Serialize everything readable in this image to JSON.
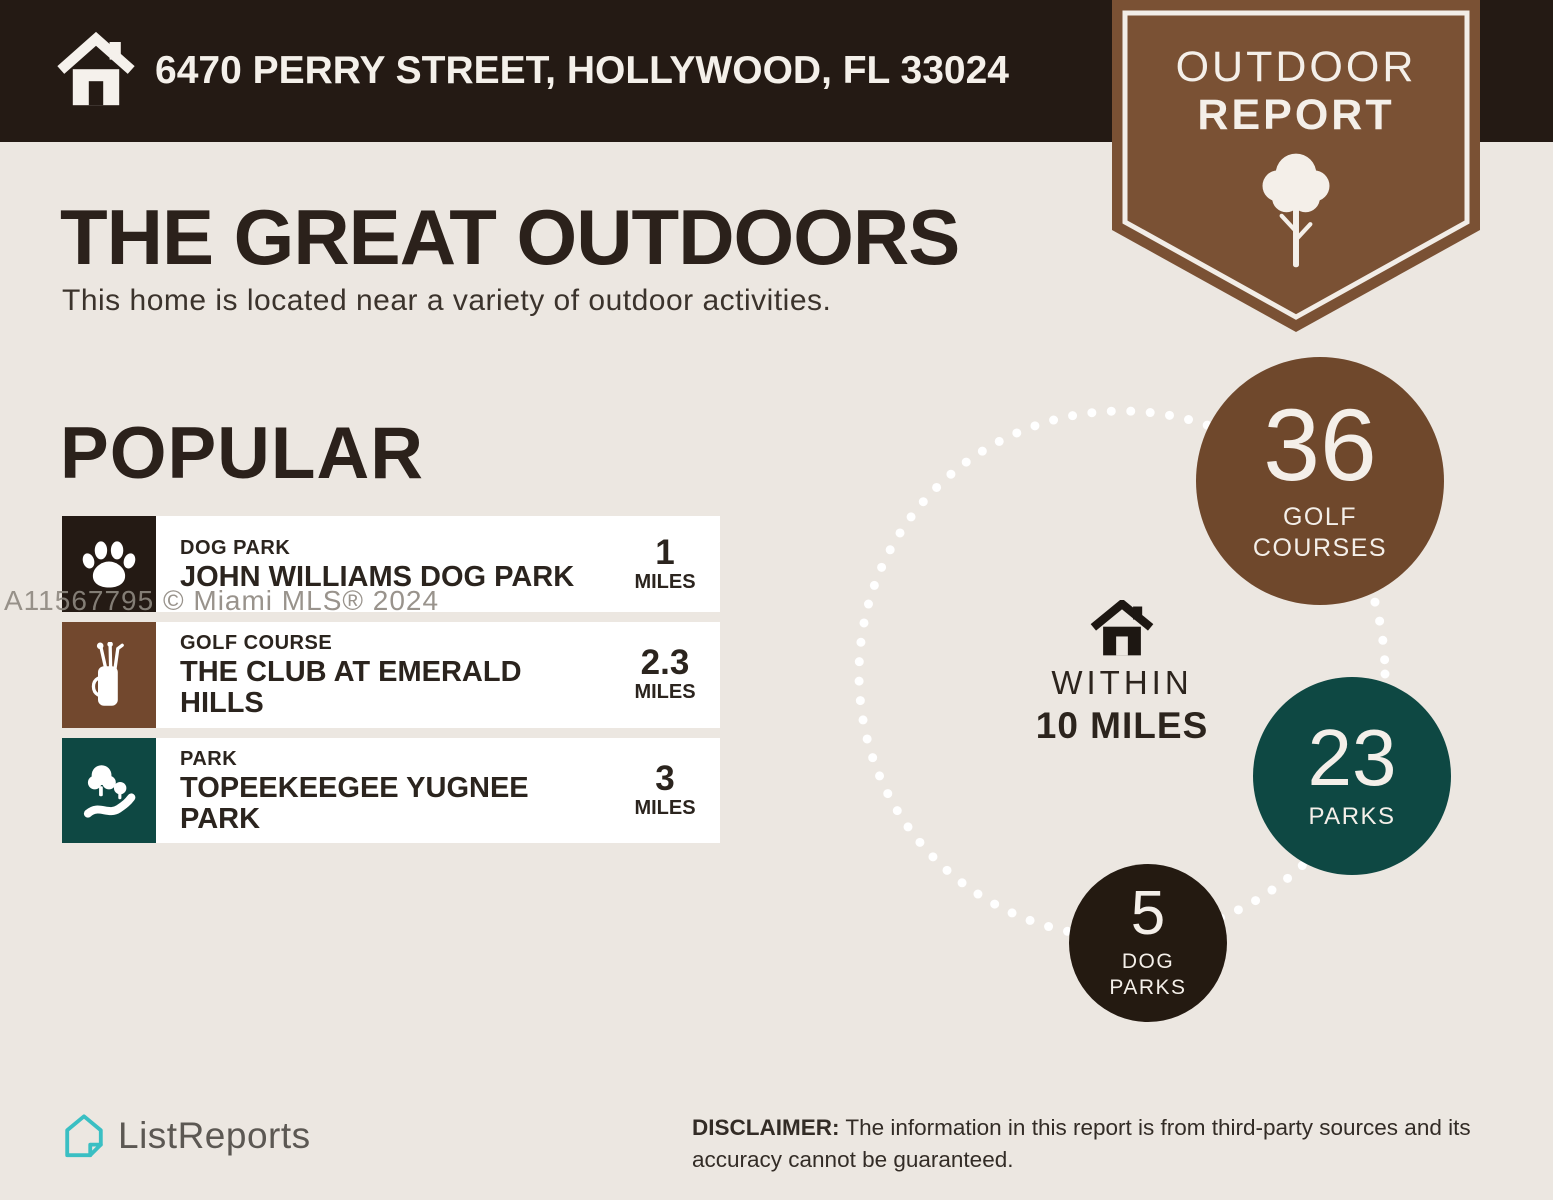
{
  "header": {
    "address": "6470 PERRY STREET, HOLLYWOOD, FL 33024"
  },
  "badge": {
    "line1": "OUTDOOR",
    "line2": "REPORT",
    "icon": "tree-icon",
    "color": "#7a5134"
  },
  "intro": {
    "title": "THE GREAT OUTDOORS",
    "subtitle": "This home is located near a variety of outdoor activities."
  },
  "popular": {
    "heading": "POPULAR",
    "items": [
      {
        "category": "DOG PARK",
        "name": "JOHN WILLIAMS DOG PARK",
        "distance": "1",
        "unit": "MILES",
        "icon": "paw-icon",
        "color": "#241a14"
      },
      {
        "category": "GOLF COURSE",
        "name": "THE CLUB AT EMERALD HILLS",
        "distance": "2.3",
        "unit": "MILES",
        "icon": "golf-bag-icon",
        "color": "#72482e"
      },
      {
        "category": "PARK",
        "name": "TOPEEKEEGEE YUGNEE PARK",
        "distance": "3",
        "unit": "MILES",
        "icon": "park-icon",
        "color": "#0e4843"
      }
    ]
  },
  "radius": {
    "icon": "home-icon",
    "line1": "WITHIN",
    "line2": "10 MILES"
  },
  "stats": [
    {
      "value": "36",
      "label": "GOLF COURSES",
      "color": "#6f482c"
    },
    {
      "value": "23",
      "label": "PARKS",
      "color": "#0e4843"
    },
    {
      "value": "5",
      "label": "DOG PARKS",
      "color": "#241a11"
    }
  ],
  "watermark": "A11567795 © Miami MLS® 2024",
  "footer": {
    "brand": "ListReports",
    "brand_icon": "listreports-logo-icon",
    "disclaimer_label": "DISCLAIMER:",
    "disclaimer_text": "The information in this report is from third-party sources and its accuracy cannot be guaranteed."
  },
  "colors": {
    "background": "#ece7e1",
    "top_bar": "#241a14",
    "badge_brown": "#7a5134",
    "stat_brown": "#6f482c",
    "stat_teal": "#0e4843",
    "stat_black": "#241a11",
    "brand_teal": "#3abfc3",
    "card": "#ffffff",
    "dots": "#ffffff"
  }
}
